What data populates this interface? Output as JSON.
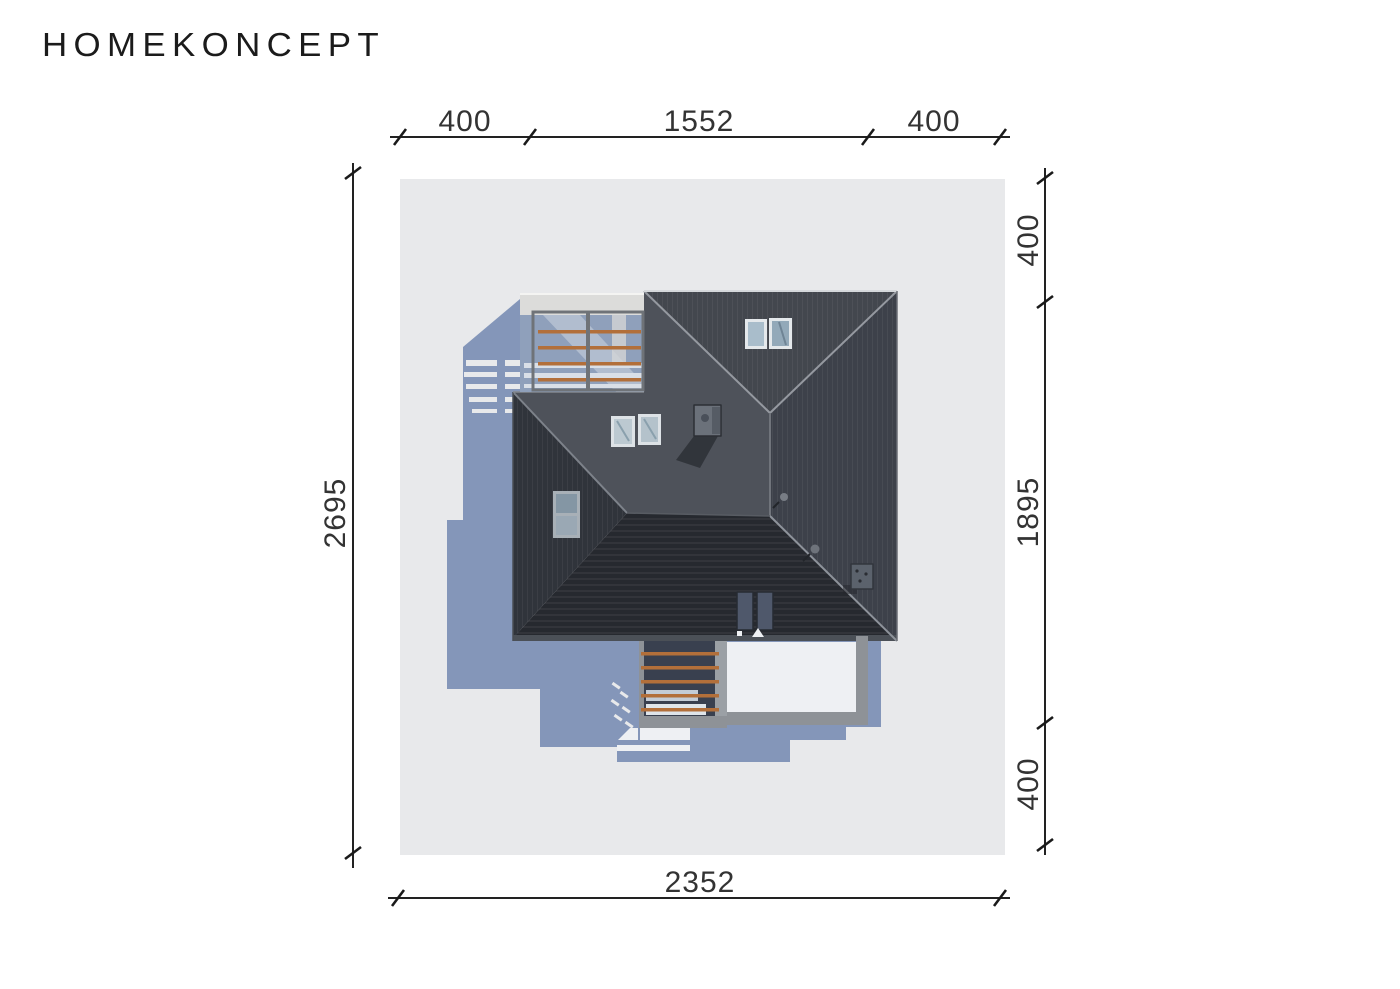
{
  "brand": {
    "logo": "HOMEKONCEPT"
  },
  "dimensions": {
    "top": {
      "left": "400",
      "middle": "1552",
      "right": "400"
    },
    "right": {
      "top": "400",
      "middle": "1895",
      "bottom": "400"
    },
    "left": {
      "total": "2695"
    },
    "bottom": {
      "total": "2352"
    }
  },
  "colors": {
    "background": "#ffffff",
    "plot": "#e8e9eb",
    "shadow": "#8496b9",
    "roof_north": "#43474e",
    "roof_east": "#3d414a",
    "roof_southwest": "#4e525a",
    "roof_wing_west": "#30343b",
    "roof_south_striped": "#26292f",
    "ridge_highlight": "#9599a0",
    "eave_fascia": "#4b5057",
    "wood_rail": "#b26f3a",
    "pergola_frame": "#8e9297",
    "pergola_backdrop": "#39404f",
    "terrace_floor": "#eef0f3",
    "balcony_slab": "#dcdcda",
    "balcony_floor_shadow": "#8fa0bb",
    "skylight_glass": "#a9bdcb",
    "chimney": "#6b717a"
  }
}
